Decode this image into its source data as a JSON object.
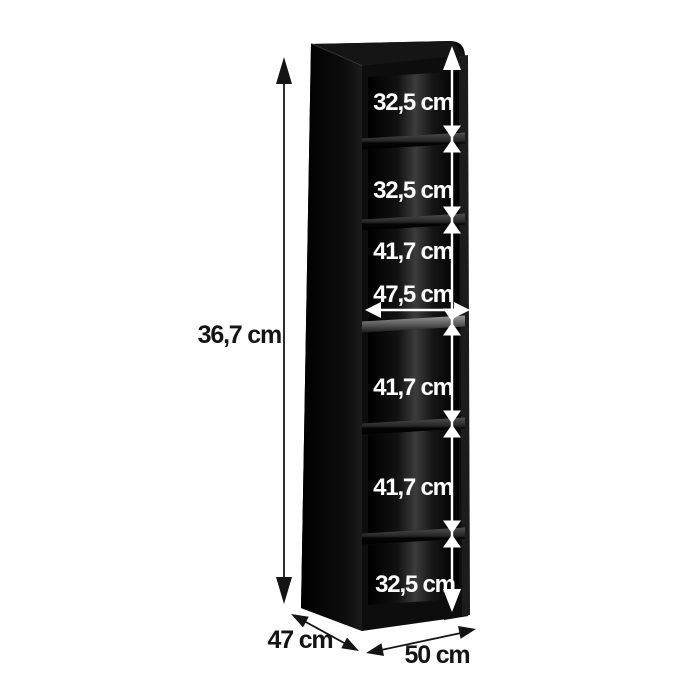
{
  "diagram": {
    "type": "furniture-dimension-diagram",
    "subject": "tall open shelving cabinet, black",
    "background_color": "#ffffff",
    "cabinet_color": "#0d0d0d",
    "inner_annotation_color": "#ffffff",
    "outer_annotation_color": "#141414",
    "total_height": {
      "label": "36,7 cm"
    },
    "depth": {
      "label": "47 cm"
    },
    "width": {
      "label": "50 cm"
    },
    "inner_width": {
      "label": "47,5 cm"
    },
    "compartments": [
      {
        "label": "32,5 cm"
      },
      {
        "label": "32,5 cm"
      },
      {
        "label": "41,7 cm"
      },
      {
        "label": "41,7 cm"
      },
      {
        "label": "41,7 cm"
      },
      {
        "label": "32,5 cm"
      }
    ]
  }
}
